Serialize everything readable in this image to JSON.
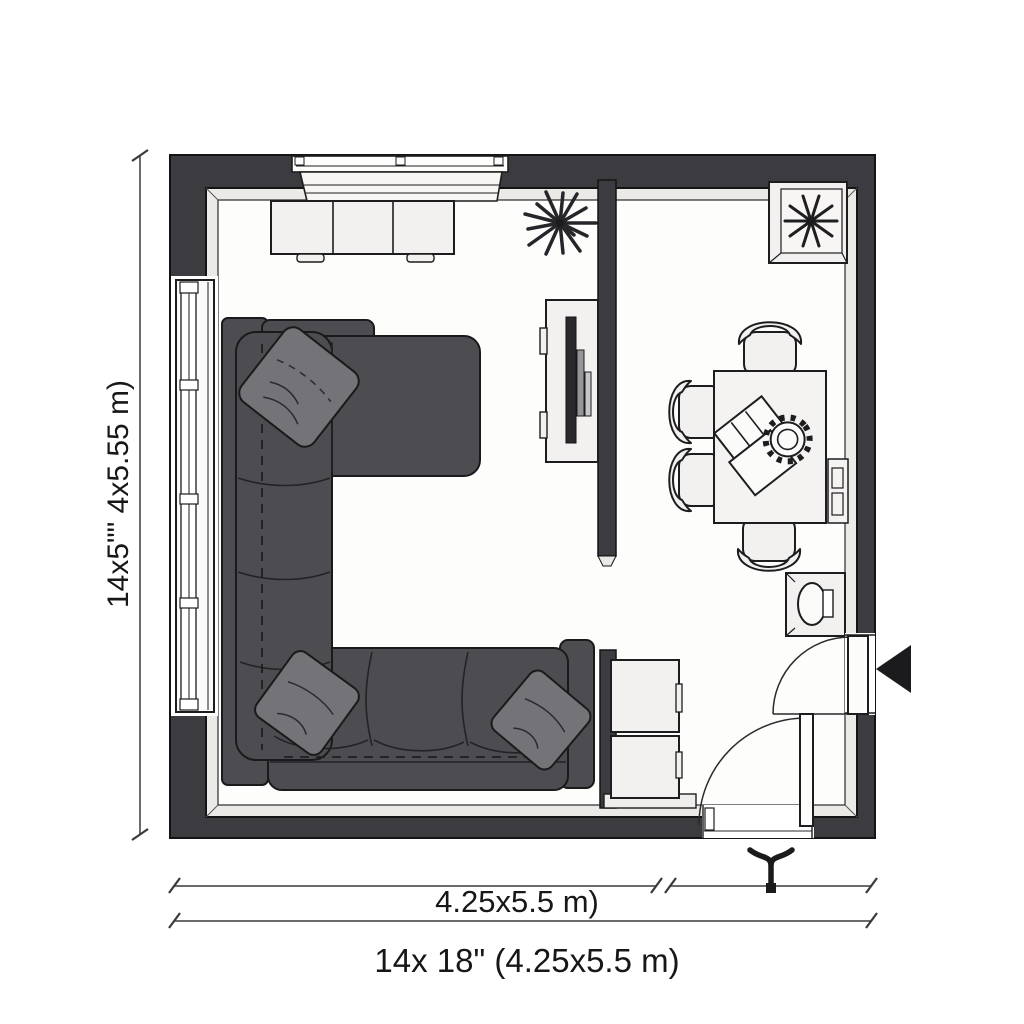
{
  "meta": {
    "type": "floor-plan",
    "rooms": [
      "living-room",
      "dining-room"
    ]
  },
  "labels": {
    "side": "14x5\"\" 4x5.55 m)",
    "width": "4.25x5.5 m)",
    "overall": "14x 18\" (4.25x5.5 m)"
  },
  "colors": {
    "wall": "#3c3c40",
    "wall_lining": "#eceae7",
    "floor": "#fdfdfc",
    "furniture_fill": "#f2f1ef",
    "outline": "#1d1d1f",
    "sofa": "#4d4d51",
    "pillow": "#747478",
    "tv": "#2a2a2c",
    "arrow": "#1b1b1d"
  },
  "elements": {
    "living_room": [
      "sectional-sofa",
      "throw-pillows",
      "side-window",
      "sideboard",
      "wall-niche",
      "tv-stand",
      "flat-tv",
      "starburst-plant",
      "partition-wall",
      "storage-cubes"
    ],
    "dining_room": [
      "dining-table",
      "dining-chairs",
      "table-setting",
      "corner-planter",
      "wall-panel",
      "washbasin-cabinet",
      "entry-door",
      "interior-door",
      "entrance-arrow"
    ]
  }
}
